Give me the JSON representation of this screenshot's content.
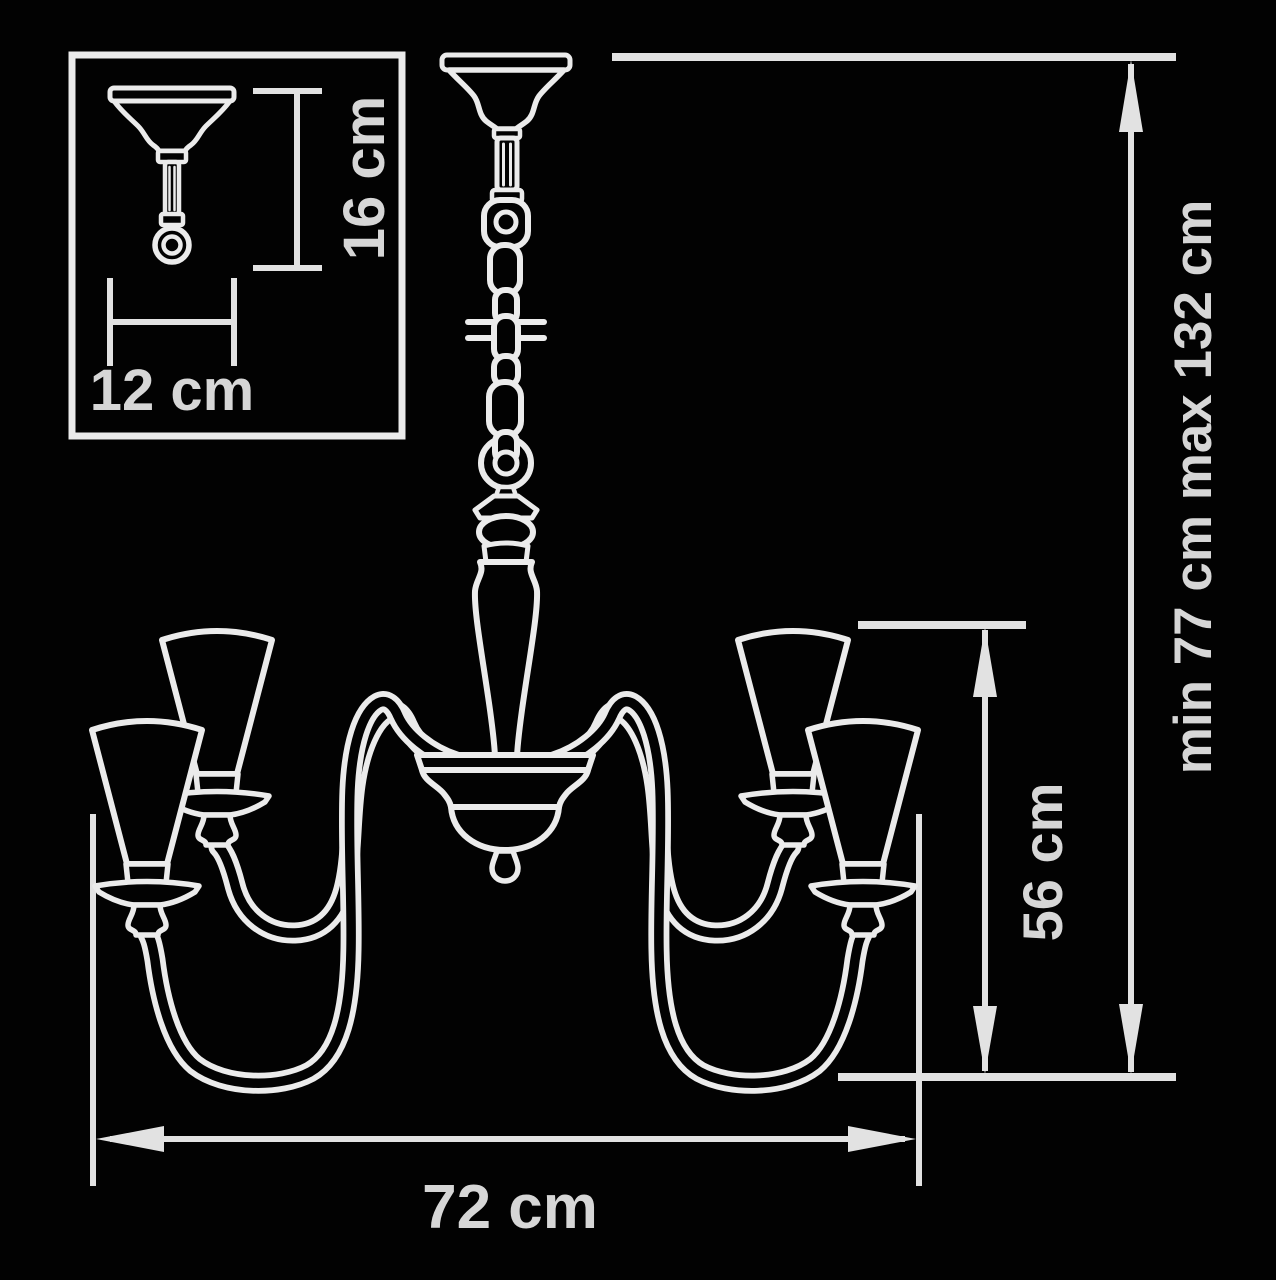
{
  "diagram": {
    "type": "chandelier-dimension-drawing",
    "background_color": "#020202",
    "line_color": "#ebebeb",
    "text_color": "#d6d6d6",
    "inset": {
      "mount_height_label": "16 cm",
      "mount_width_label": "12 cm"
    },
    "main": {
      "width_label": "72 cm",
      "body_height_label": "56 cm",
      "overall_height_label": "min 77 cm max 132 cm"
    },
    "parts": [
      "ceiling-canopy",
      "chain-suspension",
      "swivel-hook",
      "hanging-ball",
      "baluster-stem",
      "center-bowl",
      "scroll-arms",
      "cone-shades"
    ]
  }
}
